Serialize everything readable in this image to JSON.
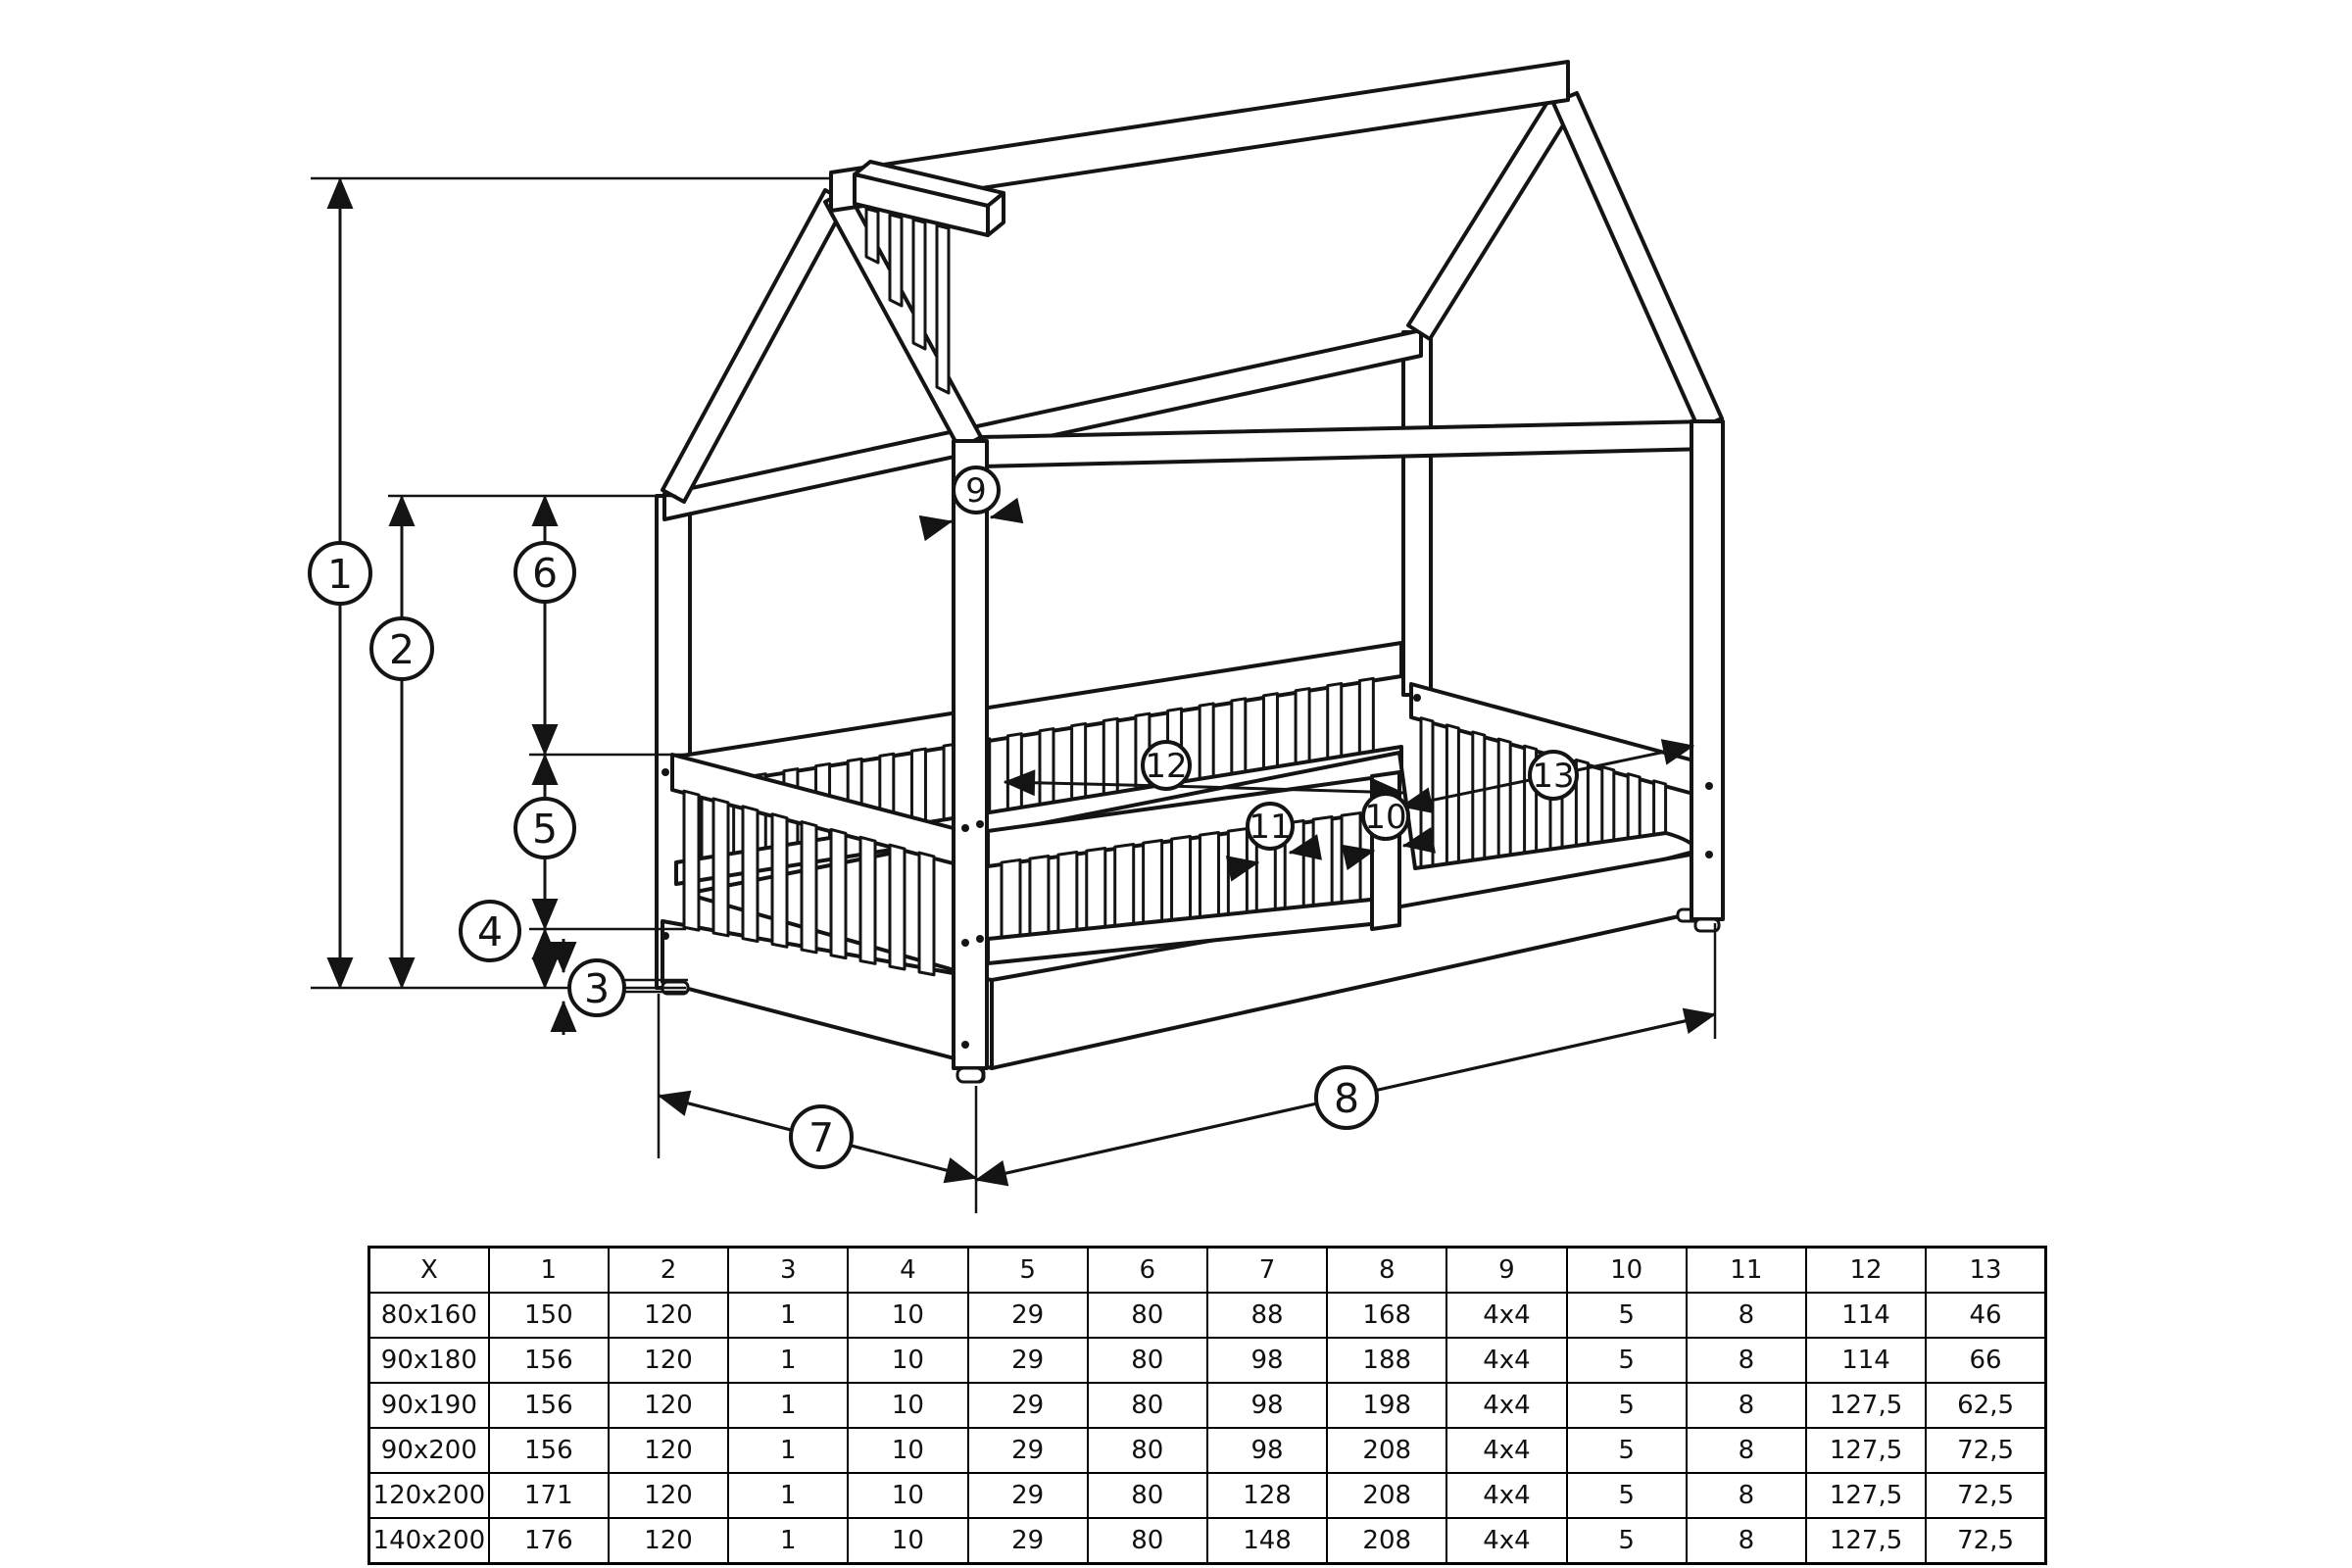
{
  "diagram": {
    "description": "house-frame-bed-technical-drawing",
    "callouts": [
      "1",
      "2",
      "3",
      "4",
      "5",
      "6",
      "7",
      "8",
      "9",
      "10",
      "11",
      "12",
      "13"
    ]
  },
  "table": {
    "header": [
      "X",
      "1",
      "2",
      "3",
      "4",
      "5",
      "6",
      "7",
      "8",
      "9",
      "10",
      "11",
      "12",
      "13"
    ],
    "rows": [
      [
        "80x160",
        "150",
        "120",
        "1",
        "10",
        "29",
        "80",
        "88",
        "168",
        "4x4",
        "5",
        "8",
        "114",
        "46"
      ],
      [
        "90x180",
        "156",
        "120",
        "1",
        "10",
        "29",
        "80",
        "98",
        "188",
        "4x4",
        "5",
        "8",
        "114",
        "66"
      ],
      [
        "90x190",
        "156",
        "120",
        "1",
        "10",
        "29",
        "80",
        "98",
        "198",
        "4x4",
        "5",
        "8",
        "127,5",
        "62,5"
      ],
      [
        "90x200",
        "156",
        "120",
        "1",
        "10",
        "29",
        "80",
        "98",
        "208",
        "4x4",
        "5",
        "8",
        "127,5",
        "72,5"
      ],
      [
        "120x200",
        "171",
        "120",
        "1",
        "10",
        "29",
        "80",
        "128",
        "208",
        "4x4",
        "5",
        "8",
        "127,5",
        "72,5"
      ],
      [
        "140x200",
        "176",
        "120",
        "1",
        "10",
        "29",
        "80",
        "148",
        "208",
        "4x4",
        "5",
        "8",
        "127,5",
        "72,5"
      ]
    ]
  },
  "colors": {
    "line": "#141414",
    "background": "#ffffff"
  }
}
